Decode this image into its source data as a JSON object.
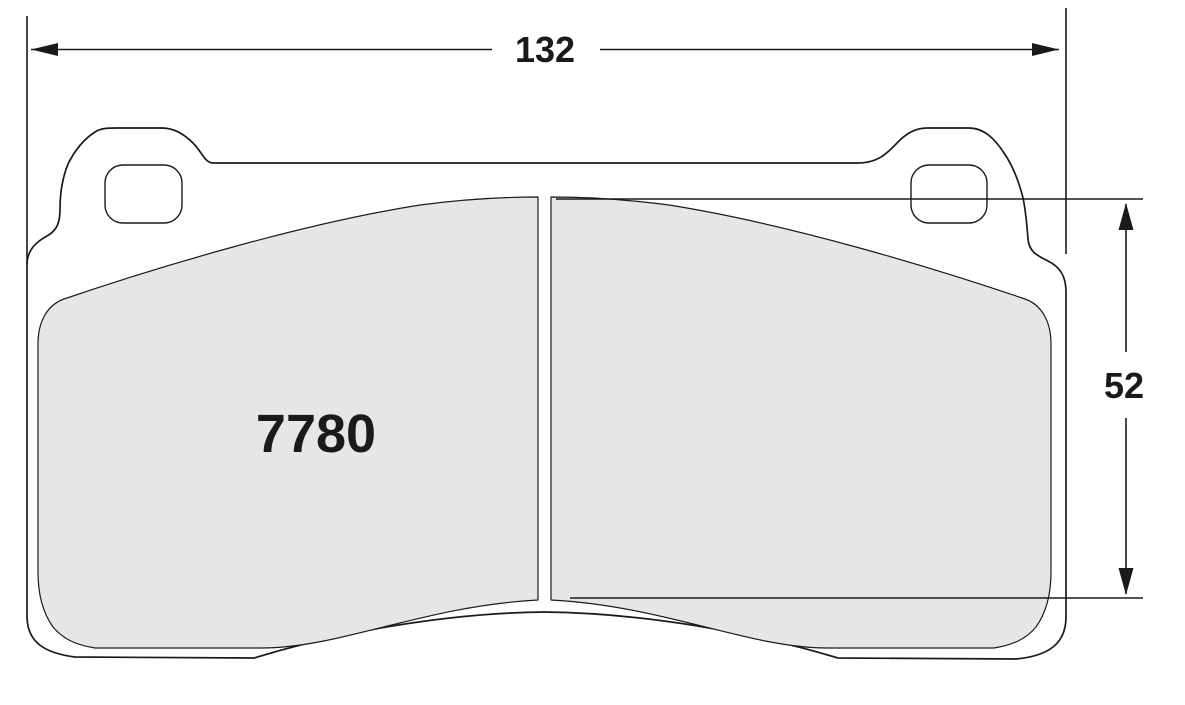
{
  "drawing": {
    "type": "brake-pad-dimensional-drawing",
    "part_number": "7780",
    "width_dim": "132",
    "height_dim": "52",
    "colors": {
      "line": "#1a1a1a",
      "friction_fill": "#e6e6e7",
      "plate_fill": "#ffffff",
      "background": "#ffffff"
    }
  }
}
